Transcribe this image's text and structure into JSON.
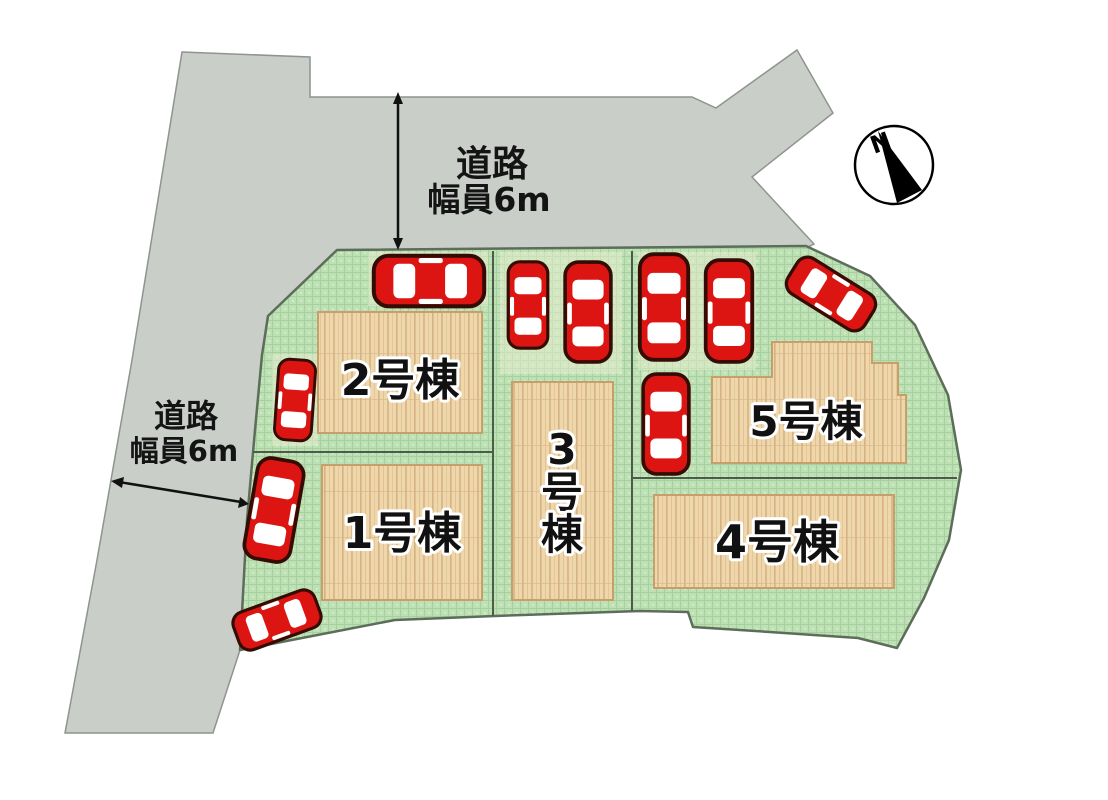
{
  "page": {
    "kind": "real-estate site plan",
    "background": "#ffffff"
  },
  "colors": {
    "road": "#c9cec9",
    "road_border": "#8e948e",
    "grass_base": "#bde0b5",
    "grass_grid": "#a7d09f",
    "lot_border": "#5c6e5a",
    "building_fill": "#eed7ab",
    "building_border": "#c69f6a",
    "car_body": "#dd1512",
    "car_outline": "#350c03",
    "car_window": "#ffffff",
    "annotation": "#111111",
    "compass_needle": "#000000"
  },
  "roads": {
    "top": {
      "line1": "道路",
      "line2": "幅員6m"
    },
    "left": {
      "line1": "道路",
      "line2": "幅員6m"
    }
  },
  "buildings": [
    {
      "label": "1号棟"
    },
    {
      "label": "2号棟"
    },
    {
      "label": "3号棟",
      "chars": [
        "3",
        "号",
        "棟"
      ]
    },
    {
      "label": "4号棟"
    },
    {
      "label": "5号棟"
    }
  ],
  "compass": {
    "north": "N"
  },
  "cars": {
    "count": 10
  }
}
